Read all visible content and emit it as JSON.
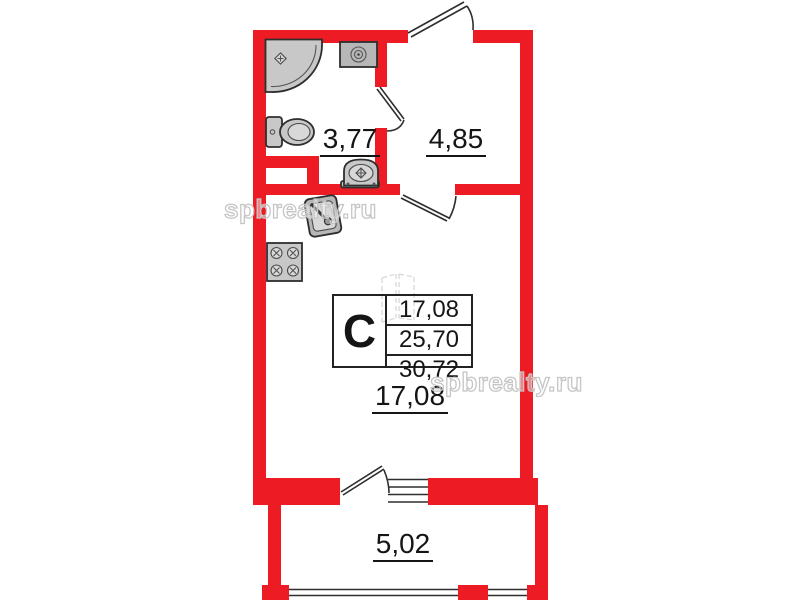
{
  "watermark_text": "spbrealty.ru",
  "rooms": {
    "bathroom": "3,77",
    "hallway": "4,85",
    "living_room": "17,08",
    "balcony": "5,02"
  },
  "area_table": {
    "studio_letter": "С",
    "living_area": "17,08",
    "floor_area": "25,70",
    "total_area": "30,72"
  },
  "colors": {
    "wall": "#ed1c24",
    "line": "#2e2e2e",
    "fixture": "#c8c8c8",
    "text": "#151515",
    "wm": "#c6c6c6"
  }
}
